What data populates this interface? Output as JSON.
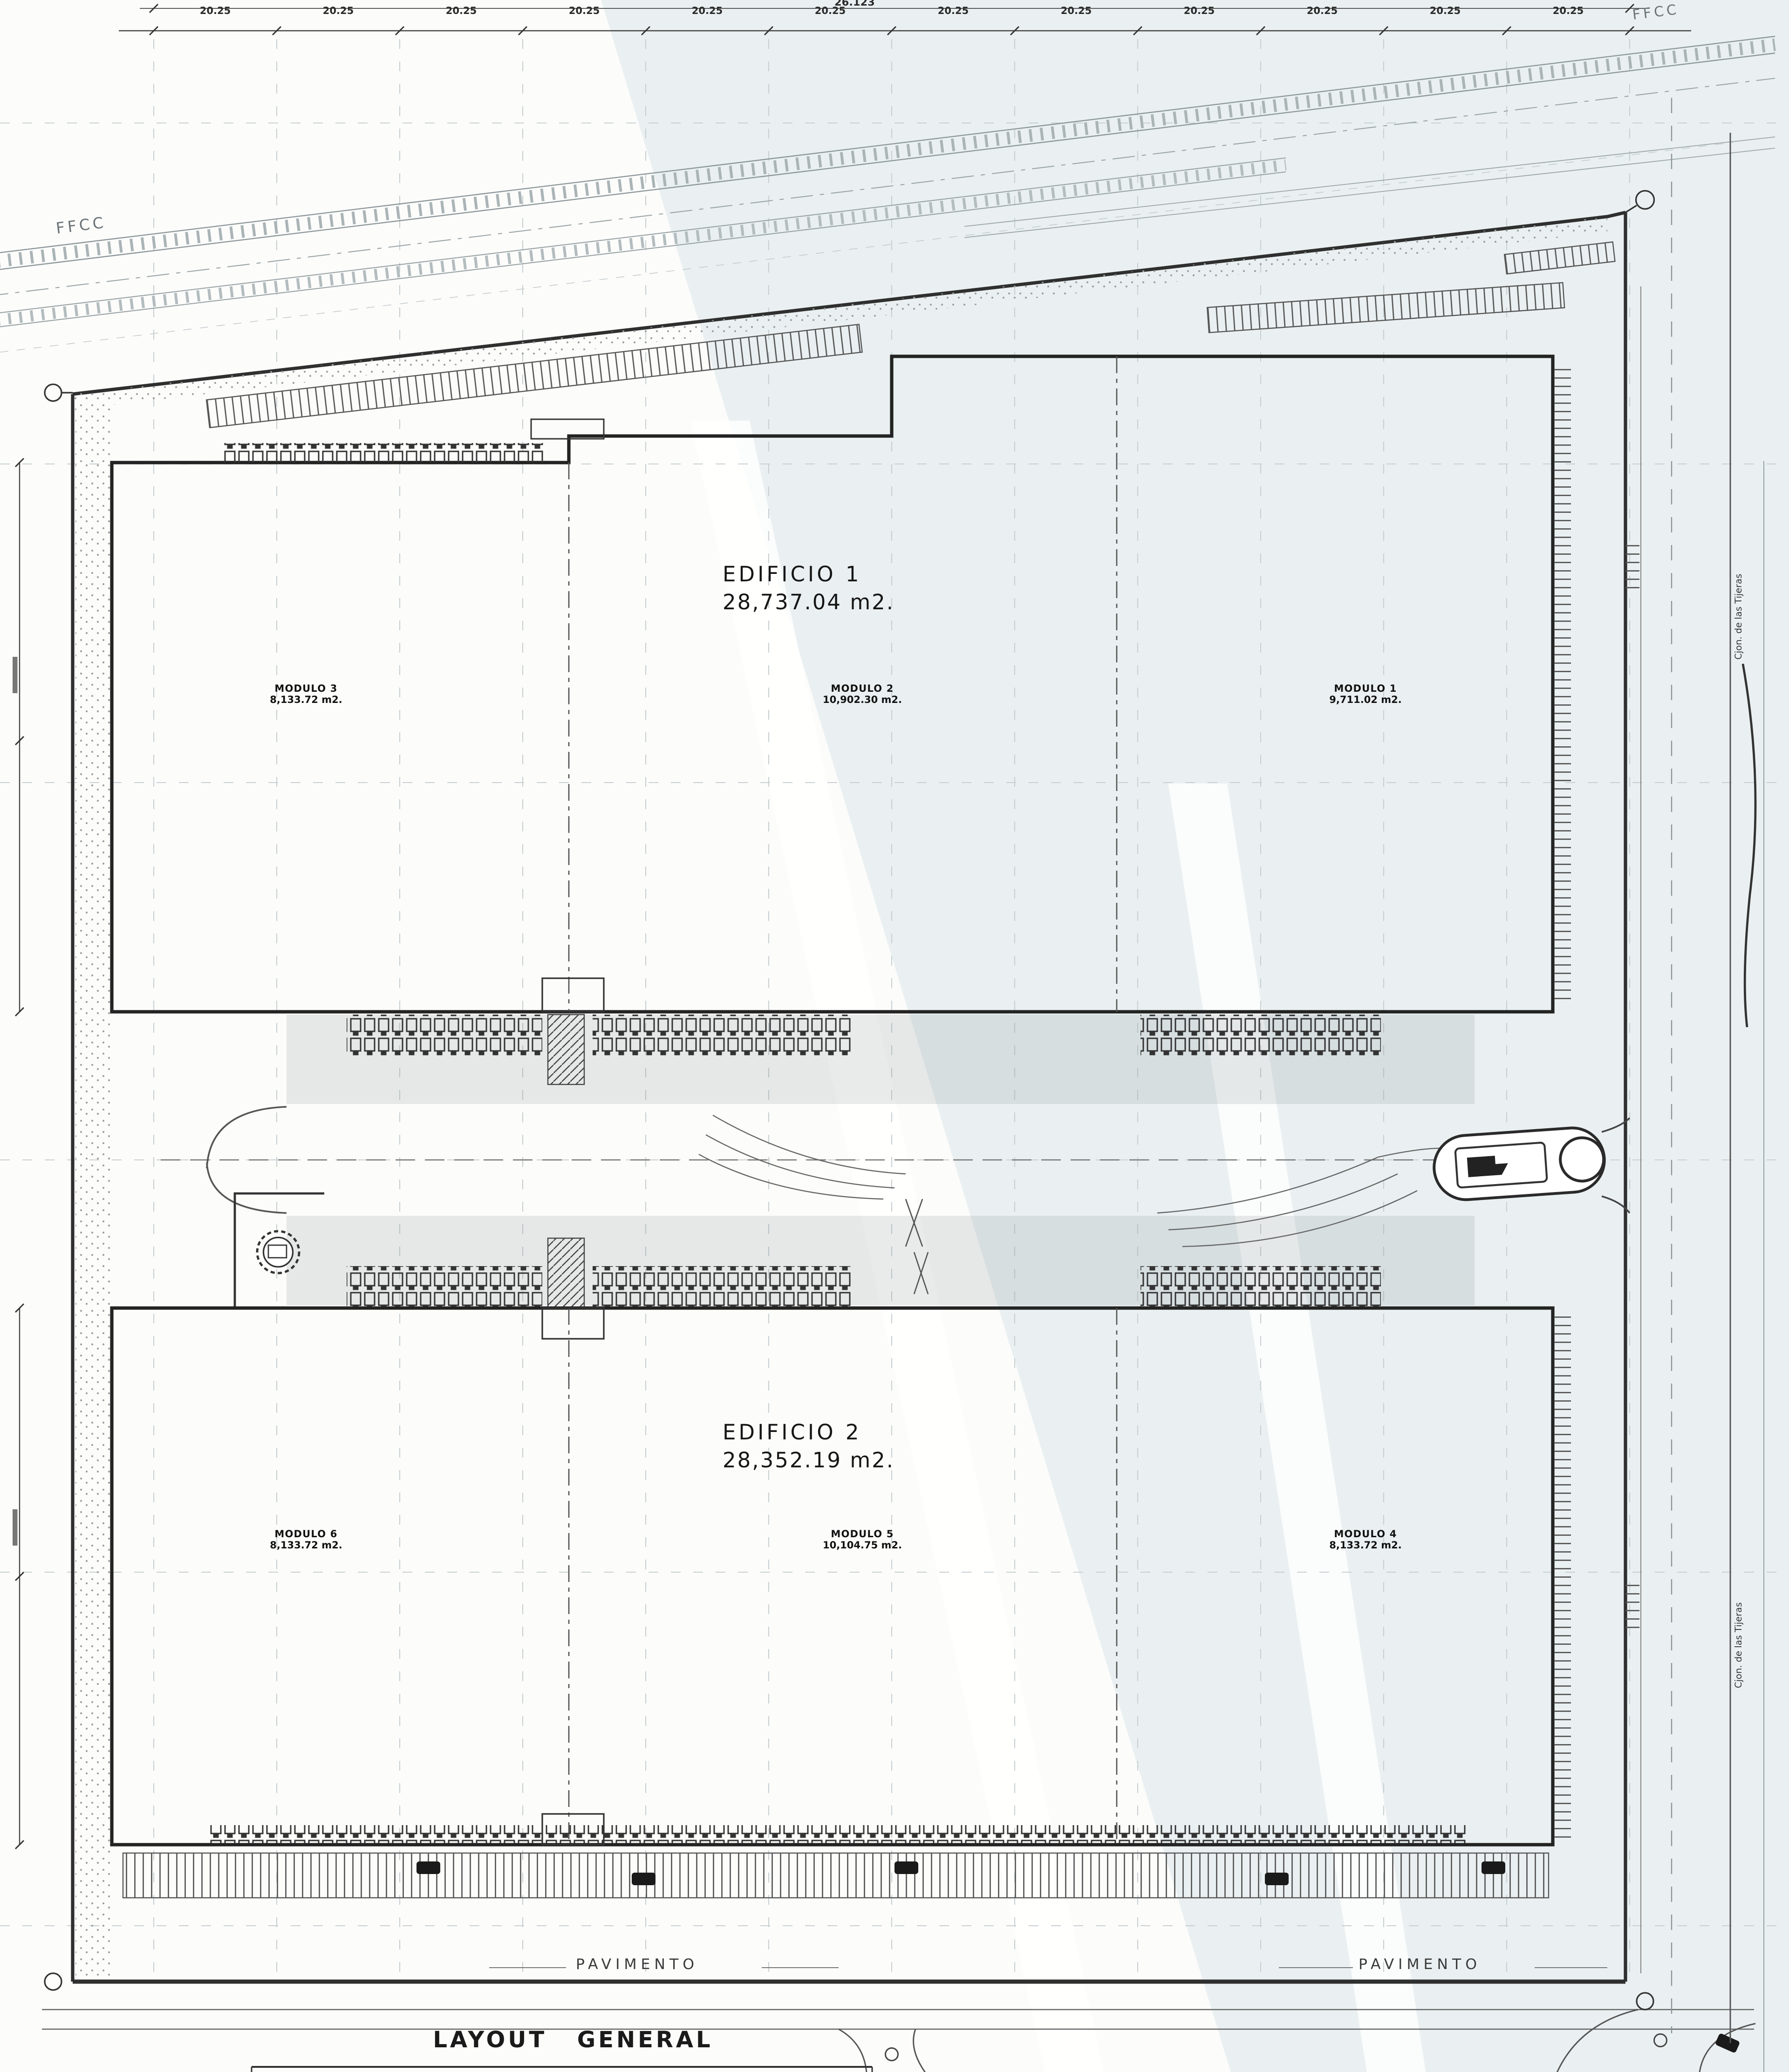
{
  "page": {
    "background": "#fcfcfb",
    "watermark_tint": "#dfe9ea",
    "ink": "#2a2a2a"
  },
  "drawing": {
    "title": "LAYOUT GENERAL",
    "railroad_label": "FFCC",
    "road_label": "Cjon. de las Tijeras",
    "pavement_label": "PAVIMENTO",
    "dimensions": {
      "total": "26.123",
      "bay": "20.25"
    },
    "buildings": [
      {
        "name": "EDIFICIO 1",
        "area": "28,737.04 m2.",
        "modules": [
          {
            "name": "MODULO 3",
            "area": "8,133.72 m2."
          },
          {
            "name": "MODULO 2",
            "area": "10,902.30 m2."
          },
          {
            "name": "MODULO 1",
            "area": "9,711.02 m2."
          }
        ]
      },
      {
        "name": "EDIFICIO 2",
        "area": "28,352.19 m2.",
        "modules": [
          {
            "name": "MODULO 6",
            "area": "8,133.72 m2."
          },
          {
            "name": "MODULO 5",
            "area": "10,104.75 m2."
          },
          {
            "name": "MODULO 4",
            "area": "8,133.72 m2."
          }
        ]
      }
    ]
  }
}
